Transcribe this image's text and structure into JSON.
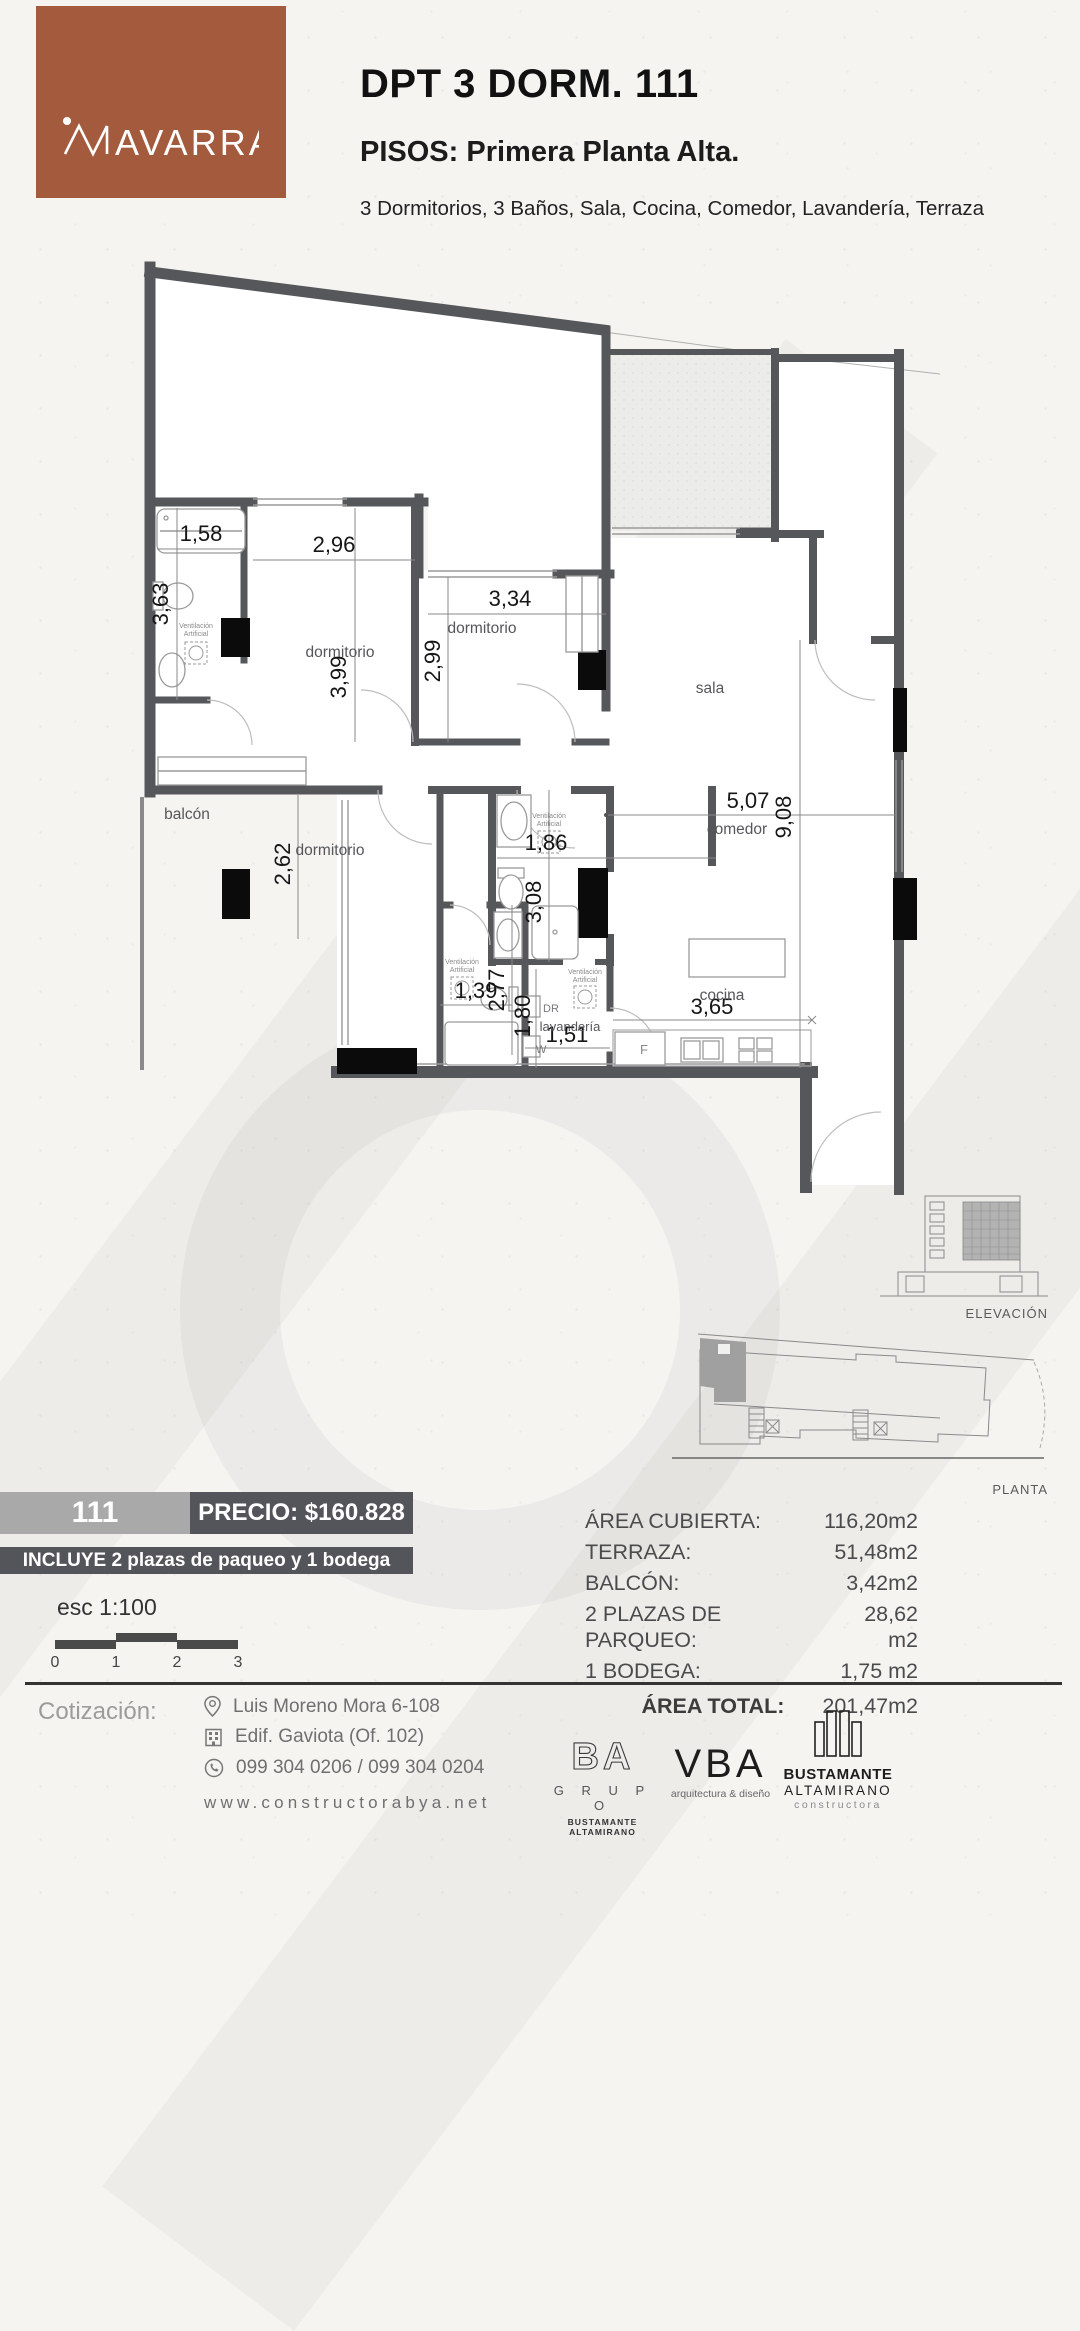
{
  "colors": {
    "brand_brown": "#a45b3d",
    "badge_gray": "#a9a9a9",
    "bar_dark": "#54555a",
    "wall_gray": "#56575b"
  },
  "header": {
    "logo_text": "AVARRA",
    "title": "DPT 3 DORM. 111",
    "subtitle": "PISOS: Primera Planta Alta.",
    "description": "3 Dormitorios, 3 Baños, Sala, Cocina, Comedor, Lavandería, Terraza"
  },
  "plan": {
    "rooms": {
      "dormitorio": "dormitorio",
      "sala": "sala",
      "comedor": "comedor",
      "cocina": "cocina",
      "balcon": "balcón",
      "lavanderia": "lavandería"
    },
    "dims": {
      "bath1_width": "1,58",
      "bath1_height": "3,63",
      "dorm1_width": "2,96",
      "dorm1_height": "3,99",
      "dorm2_width": "3,34",
      "dorm2_height": "2,99",
      "dorm3_height": "2,62",
      "bath2_width": "1,86",
      "bath2_height": "3,08",
      "bath3_width": "1,39",
      "bath3_height": "2,77",
      "laundry_height": "1,80",
      "laundry_width": "1,51",
      "kitchen_width": "3,65",
      "dining_width": "5,07",
      "living_height": "9,08"
    },
    "appliances": {
      "washer": "W",
      "dryer": "DR",
      "fridge": "F"
    },
    "vent_line1": "Ventilación",
    "vent_line2": "Artificial",
    "elevation_label": "ELEVACIÓN",
    "plant_label": "PLANTA"
  },
  "pricing": {
    "unit_number": "111",
    "price_label": "PRECIO: $160.828",
    "includes": "INCLUYE 2 plazas de paqueo y 1 bodega",
    "scale_label": "esc 1:100",
    "scale_ticks": [
      "0",
      "1",
      "2",
      "3"
    ]
  },
  "areas": {
    "rows": [
      {
        "label": "ÁREA CUBIERTA:",
        "value": "116,20m2"
      },
      {
        "label": "TERRAZA:",
        "value": "51,48m2"
      },
      {
        "label": "BALCÓN:",
        "value": "3,42m2"
      },
      {
        "label": "2 PLAZAS DE PARQUEO:",
        "value": "28,62 m2"
      },
      {
        "label": "1 BODEGA:",
        "value": "1,75 m2"
      }
    ],
    "total_label": "ÁREA TOTAL:",
    "total_value": "201,47m2"
  },
  "footer": {
    "quote_label": "Cotización:",
    "contacts": [
      {
        "icon": "location-pin-icon",
        "text": "Luis Moreno Mora 6-108"
      },
      {
        "icon": "building-icon",
        "text": "Edif. Gaviota (Of. 102)"
      },
      {
        "icon": "whatsapp-icon",
        "text": "099 304 0206 / 099 304 0204"
      }
    ],
    "website": "www.constructorabya.net",
    "logos": {
      "ba": {
        "name": "BA",
        "group": "G R U P O",
        "sub": "BUSTAMANTE ALTAMIRANO"
      },
      "vba": {
        "name": "VBA",
        "sub": "arquitectura & diseño"
      },
      "bac": {
        "line1": "BUSTAMANTE",
        "line2": "ALTAMIRANO",
        "line3": "constructora"
      }
    }
  }
}
